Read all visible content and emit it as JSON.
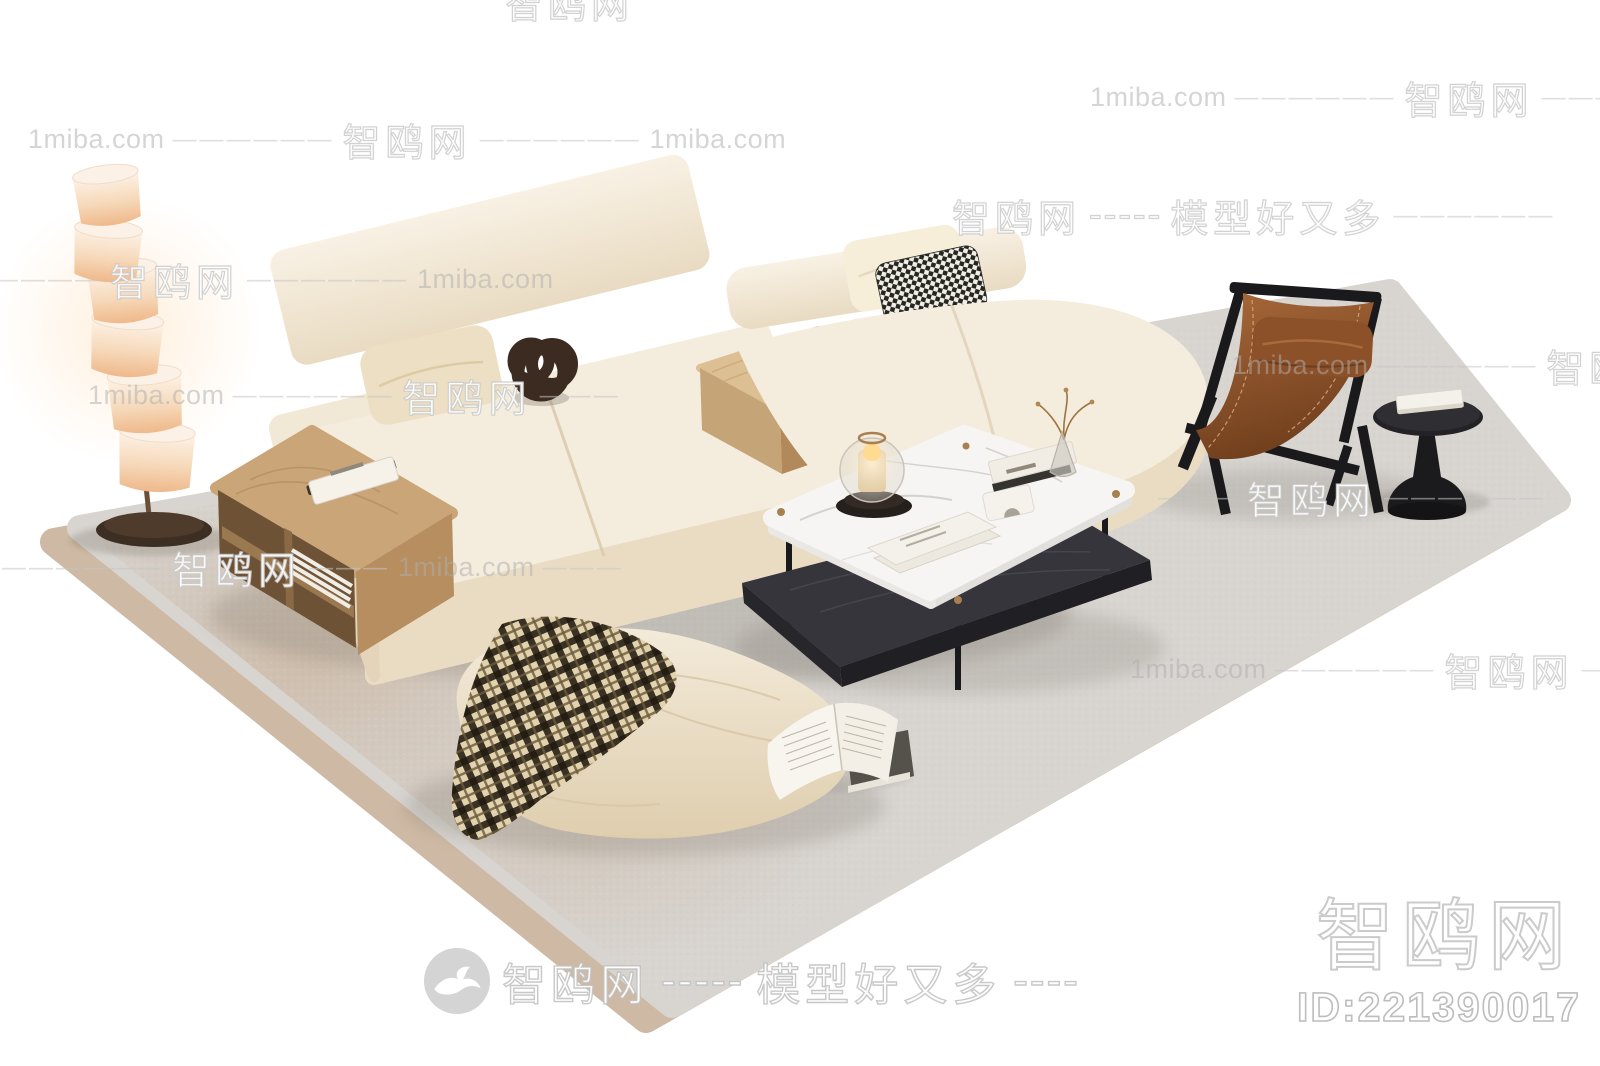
{
  "page": {
    "background": "#ffffff"
  },
  "watermark": {
    "site": "1miba.com",
    "brand": "智鸥网",
    "slogan": "模型好又多",
    "dash6": "——————",
    "dash3": "———",
    "hyph5": "-----",
    "hyph4": "----"
  },
  "badge": {
    "logo_icon": "seagull-icon",
    "brand": "智鸥网",
    "hyphens": "-----",
    "slogan": "模型好又多",
    "trailing": "----"
  },
  "id_block": {
    "brand": "智鸥网",
    "model_id": "ID:221390017"
  },
  "colors": {
    "bg": "#ffffff",
    "under-rug": "#cdb9a4",
    "rug": "#d8d5d1",
    "sofa": "#f4ecdc",
    "sofa-front": "#eadcc3",
    "sofa-side": "#e3d4ba",
    "wood": "#c9a578",
    "wood-dark": "#6e5236",
    "marble": "#f6f5f3",
    "table-black": "#35353b",
    "metal-black": "#1a1a1d",
    "leather": "#9a5c30",
    "knot": "#3c2b20",
    "lamp-shade": "#f8e7d6",
    "lamp-base": "#3d2e23",
    "pouf": "#efe4d0",
    "gold": "#a87f4f"
  },
  "scene": {
    "description": "3D living-room furniture set render",
    "items": [
      "area-rug",
      "floor-lamp",
      "wood-side-shelf",
      "modular-sofa",
      "beige-pillow",
      "houndstooth-pillow",
      "knot-ornament",
      "middle-wood-table",
      "coffee-table",
      "candle-lantern",
      "magazines",
      "book-stack",
      "flower-vase",
      "white-sculpture",
      "leather-lounge-chair",
      "round-side-table",
      "pouf",
      "plaid-blanket",
      "open-book"
    ]
  }
}
